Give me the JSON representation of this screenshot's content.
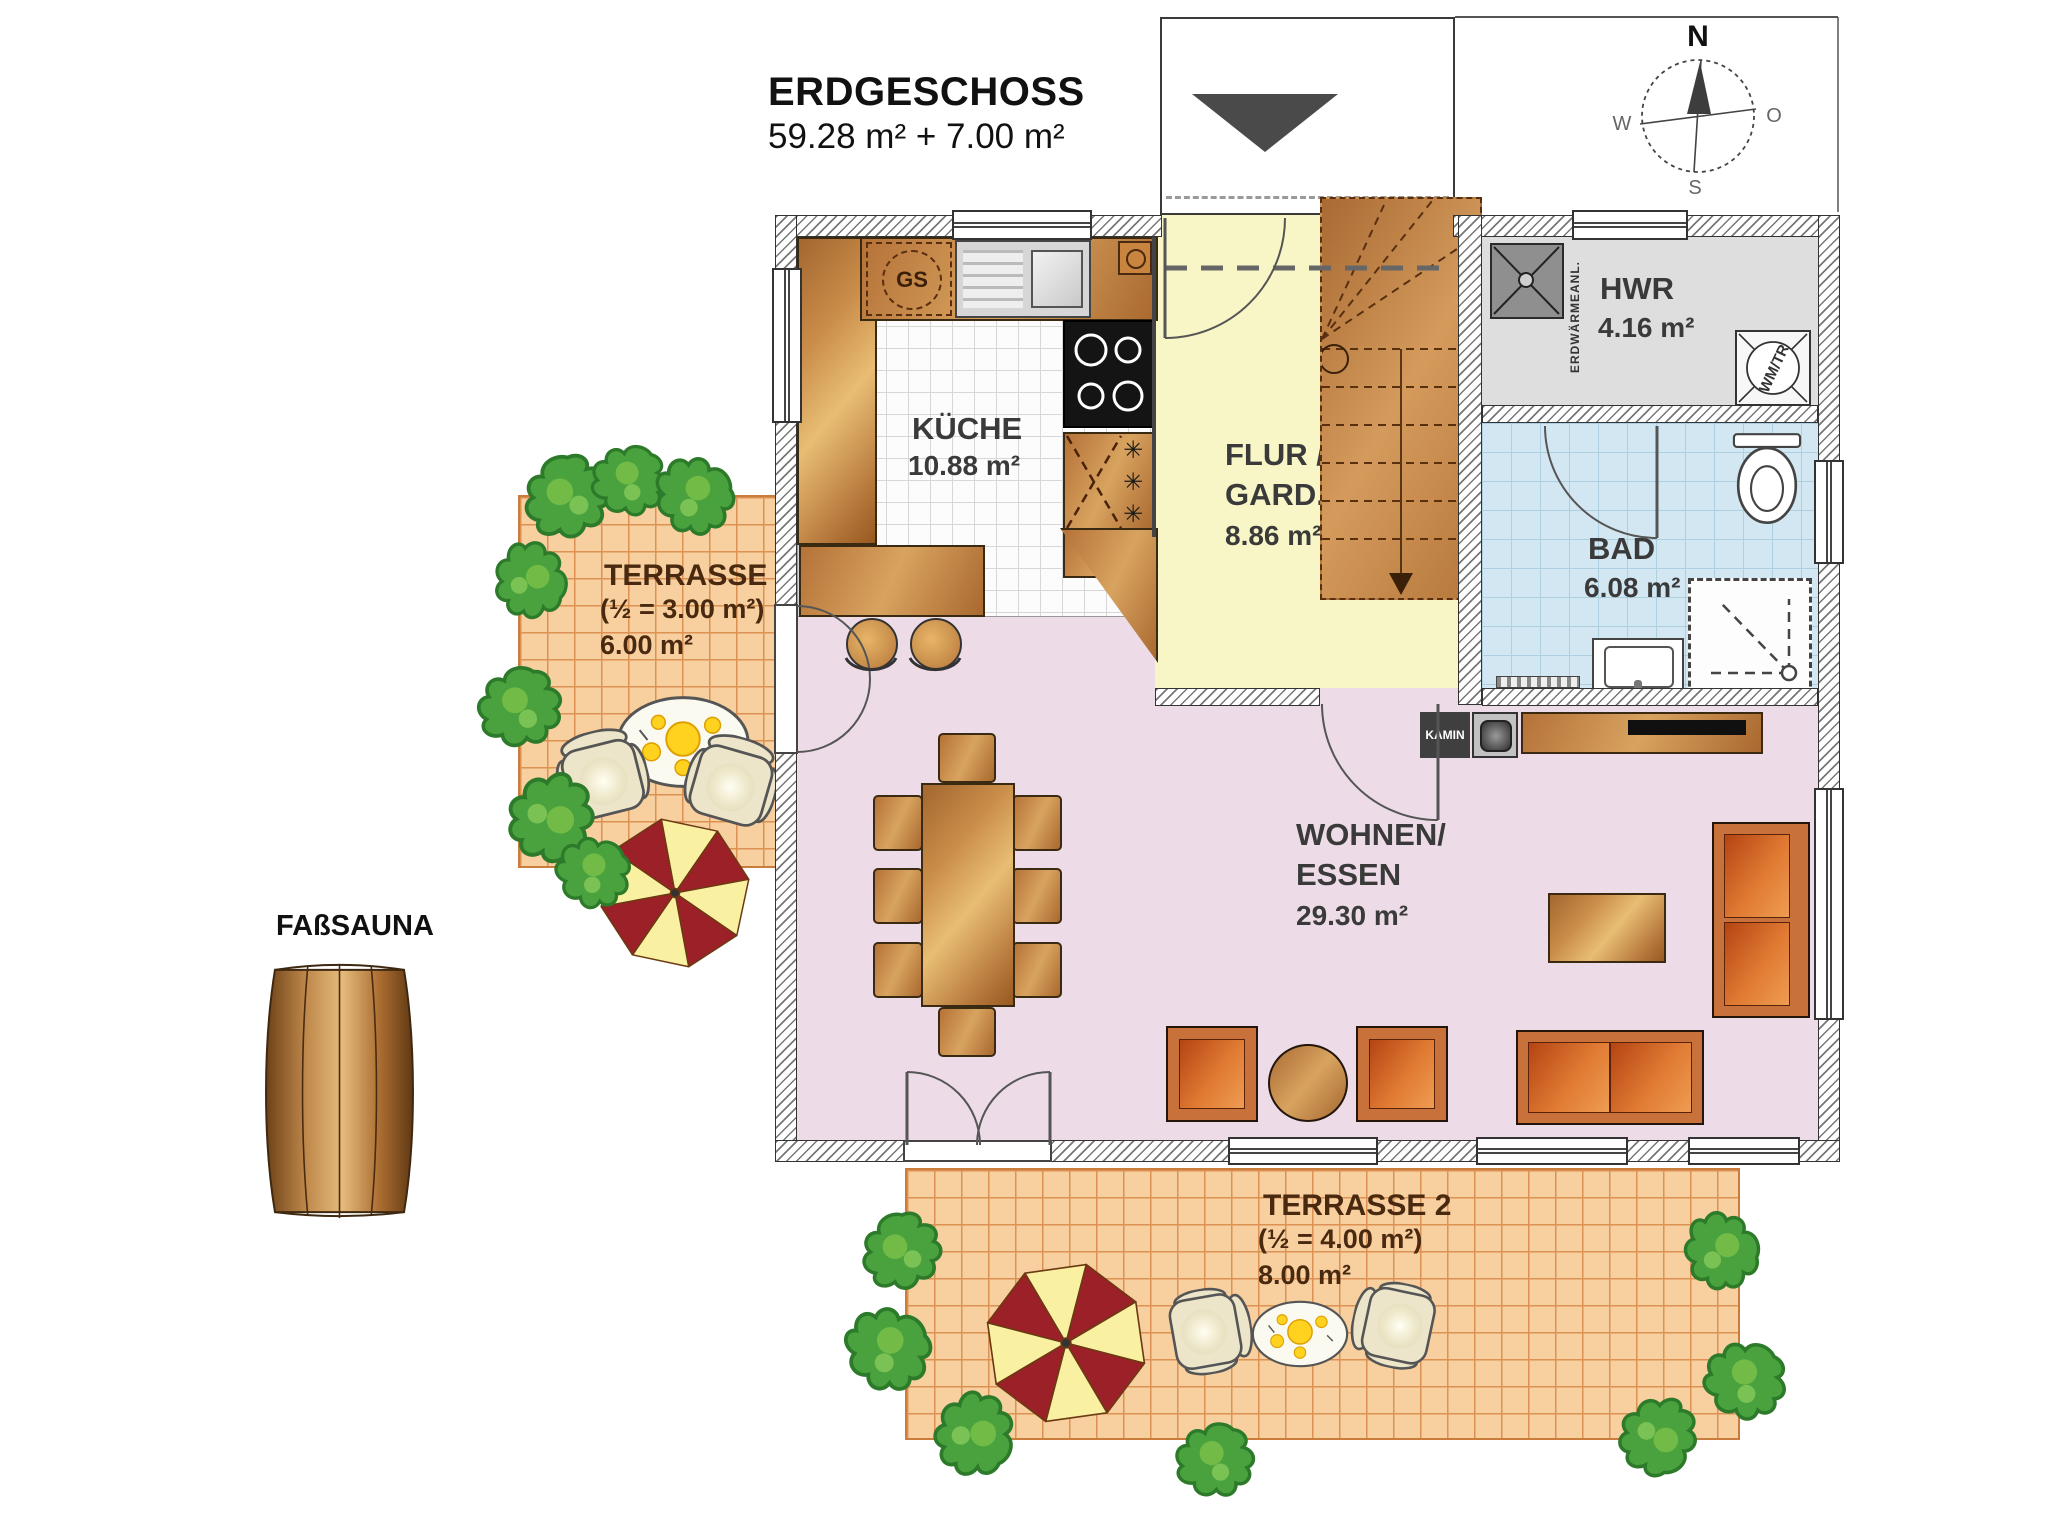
{
  "title": {
    "line1": "ERDGESCHOSS",
    "line2": "59.28 m² + 7.00 m²"
  },
  "compass": {
    "north": "N",
    "east": "O",
    "south": "S",
    "west": "W"
  },
  "rooms": {
    "kueche": {
      "name": "KÜCHE",
      "area": "10.88 m²"
    },
    "flur": {
      "name_line1": "FLUR /",
      "name_line2": "GARD.",
      "area": "8.86 m²"
    },
    "hwr": {
      "name": "HWR",
      "area": "4.16 m²"
    },
    "bad": {
      "name": "BAD",
      "area": "6.08 m²"
    },
    "wohnen_essen": {
      "name_line1": "WOHNEN/",
      "name_line2": "ESSEN",
      "area": "29.30 m²"
    }
  },
  "terraces": {
    "terrasse1": {
      "name": "TERRASSE 1",
      "half_note": "(½ = 3.00 m²)",
      "area": "6.00 m²"
    },
    "terrasse2": {
      "name": "TERRASSE 2",
      "half_note": "(½ = 4.00 m²)",
      "area": "8.00 m²"
    }
  },
  "annotations": {
    "kamin": "KAMIN",
    "fasssauna": "FAßSAUNA",
    "gs": "GS",
    "wm_tr": "WM/TR",
    "erdwaerme": "ERDWÄRMEANL."
  },
  "colors": {
    "living": "#eddce7",
    "hall": "#f8f6c6",
    "hwr": "#dedede",
    "bath": "#d3e7f2",
    "terrace": "#f8cf9e",
    "wood": "#c8854f",
    "umbrella_red": "#9b2028",
    "umbrella_yellow": "#faf0a2",
    "bush_green": "#4aa23e",
    "sofa_orange": "#d2622b"
  }
}
